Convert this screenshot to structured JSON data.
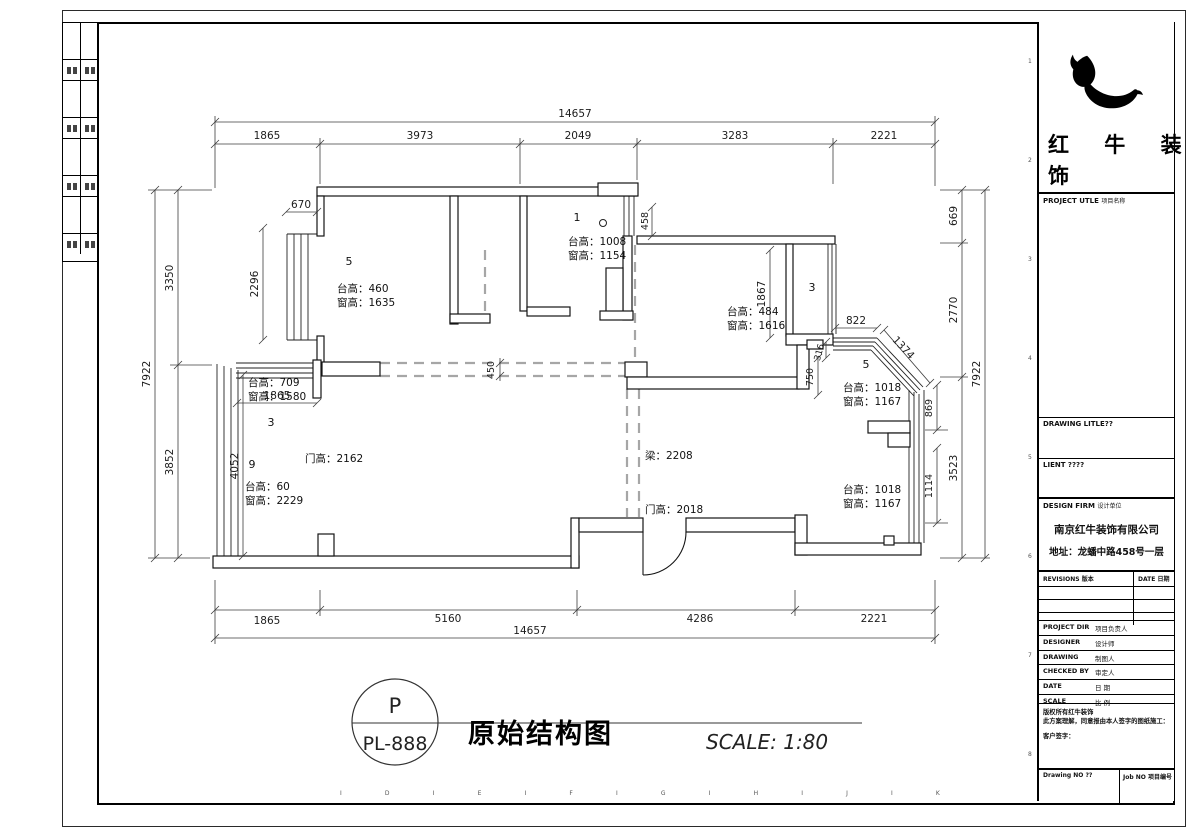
{
  "sheet": {
    "grid_letters": [
      "I",
      "D",
      "I",
      "E",
      "I",
      "F",
      "I",
      "G",
      "I",
      "H",
      "I",
      "J",
      "I",
      "K"
    ],
    "grid_numbers": [
      "1",
      "2",
      "3",
      "4",
      "5",
      "6",
      "7",
      "8"
    ]
  },
  "plan": {
    "dims": {
      "top_total": "14657",
      "top_segments": [
        "1865",
        "3973",
        "2049",
        "3283",
        "2221"
      ],
      "bottom_segments": [
        "1865",
        "5160",
        "4286",
        "2221"
      ],
      "bottom_total": "14657",
      "left_total": "7922",
      "left_top": "3350",
      "left_bottom": "3852",
      "right_top": "669",
      "right_mid": "2770",
      "right_bottom": "3523",
      "right_total": "7922",
      "inner": {
        "bay_tl_width": "670",
        "bay_tl_height": "2296",
        "balcony_width": "1865",
        "balcony_height": "4052",
        "beam_width": "450",
        "win_mid": "458",
        "bedroom_height": "1867",
        "bay_r_top": "822",
        "bay_r_diag": "1374",
        "bay_r_step": "316",
        "bay_r_drop": "750",
        "win_r_upper": "869",
        "win_r_lower": "1114"
      }
    },
    "rooms": {
      "room_tl_num": "5",
      "room_tl": [
        "台高：460",
        "窗高：1635"
      ],
      "bath_num": "1",
      "bath": [
        "台高：1008",
        "窗高：1154"
      ],
      "bedroom": [
        "台高：484",
        "窗高：1616"
      ],
      "room3_num": "3",
      "bay_r_num": "5",
      "bay_r": [
        "台高：1018",
        "窗高：1167"
      ],
      "balcony_num": "3",
      "balcony": [
        "台高：709",
        "窗高：1580"
      ],
      "living_num": "9",
      "living": [
        "台高：60",
        "窗高：2229"
      ],
      "door_living": "门高：2162",
      "beam": "梁：2208",
      "door_entry": "门高：2018",
      "win_br": [
        "台高：1018",
        "窗高：1167"
      ]
    }
  },
  "footer": {
    "bubble_top": "P",
    "bubble_code": "PL-888",
    "title": "原始结构图",
    "scale": "SCALE: 1:80"
  },
  "title_block": {
    "brand_line1": "红 牛 装",
    "brand_line2": "饰",
    "project_title_en": "PROJECT UTLE",
    "project_title_zh": "项目名称",
    "drawing_title_en": "DRAWING LITLE??",
    "client_en": "LIENT ????",
    "design_firm_en": "DESIGN FIRM",
    "design_firm_zh": "设计单位",
    "firm_name": "南京红牛装饰有限公司",
    "firm_address": "地址：龙蟠中路458号一层",
    "revisions_en": "REVISIONS",
    "revisions_zh": "版本",
    "date_en": "DATE",
    "date_zh": "日期",
    "rows": [
      {
        "en": "PROJECT DIR",
        "zh": "项目负责人"
      },
      {
        "en": "DESIGNER",
        "zh": "设计师"
      },
      {
        "en": "DRAWING",
        "zh": "制图人"
      },
      {
        "en": "CHECKED BY",
        "zh": "审定人"
      },
      {
        "en": "DATE",
        "zh": "日  期"
      },
      {
        "en": "SCALE",
        "zh": "比  例"
      }
    ],
    "copyright_1": "版权所有红牛装饰",
    "copyright_2": "此方案理解，同意报由本人签字的图纸施工：",
    "copyright_3": "客户签字：",
    "drawing_no": "Drawing NO ??",
    "job_no": "Job NO 项目编号"
  }
}
